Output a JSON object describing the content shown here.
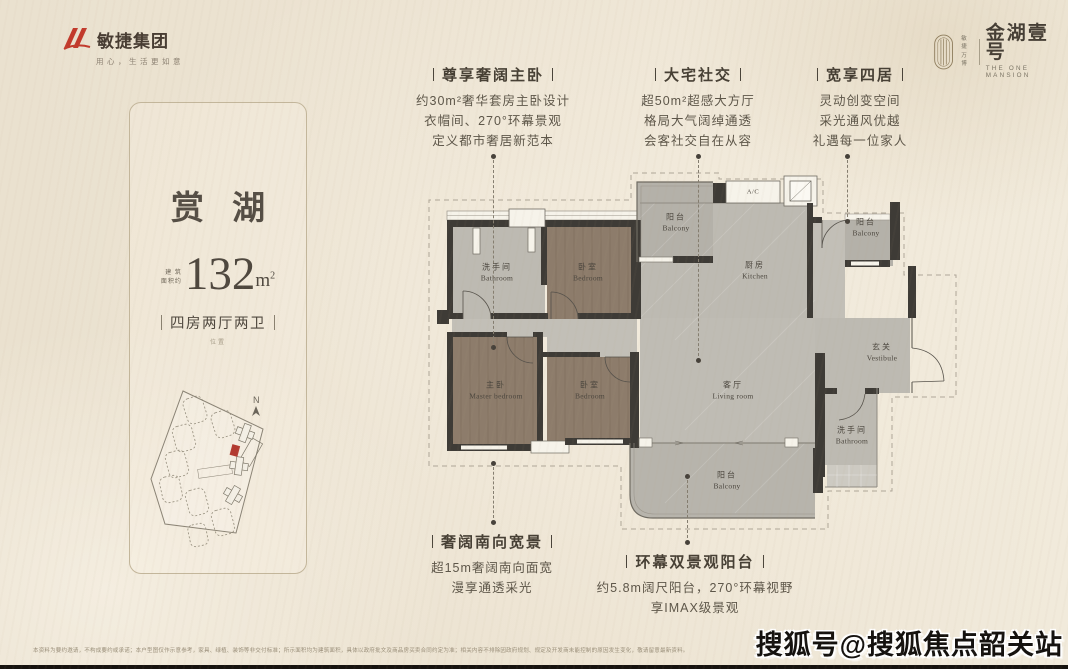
{
  "brand_left": {
    "name": "敏捷集团",
    "slogan": "用心，生活更如意"
  },
  "brand_right": {
    "tag1": "敏捷",
    "tag2": "万博",
    "name": "金湖壹号",
    "name_en": "THE ONE MANSION"
  },
  "card": {
    "title": "赏 湖",
    "area_label_1": "建 筑",
    "area_label_2": "面积约",
    "area_value": "132",
    "area_unit_base": "m",
    "area_unit_sup": "2",
    "layout": "四房两厅两卫",
    "layout_note": "位置",
    "compass_n": "N"
  },
  "plan": {
    "ac": "A/C",
    "rooms": [
      {
        "cn": "洗手间",
        "en": "Bathroom"
      },
      {
        "cn": "卧室",
        "en": "Bedroom"
      },
      {
        "cn": "阳台",
        "en": "Balcony"
      },
      {
        "cn": "厨房",
        "en": "Kitchen"
      },
      {
        "cn": "阳台",
        "en": "Balcony"
      },
      {
        "cn": "玄关",
        "en": "Vestibule"
      },
      {
        "cn": "客厅",
        "en": "Living room"
      },
      {
        "cn": "主卧",
        "en": "Master bedroom"
      },
      {
        "cn": "卧室",
        "en": "Bedroom"
      },
      {
        "cn": "阳台",
        "en": "Balcony"
      },
      {
        "cn": "洗手间",
        "en": "Bathroom"
      }
    ]
  },
  "annotations": [
    {
      "title": "尊享奢阔主卧",
      "lines": [
        "约30m²奢华套房主卧设计",
        "衣帽间、270°环幕景观",
        "定义都市奢居新范本"
      ]
    },
    {
      "title": "大宅社交",
      "lines": [
        "超50m²超感大方厅",
        "格局大气阔绰通透",
        "会客社交自在从容"
      ]
    },
    {
      "title": "宽享四居",
      "lines": [
        "灵动创变空间",
        "采光通风优越",
        "礼遇每一位家人"
      ]
    },
    {
      "title": "奢阔南向宽景",
      "lines": [
        "超15m奢阔南向面宽",
        "漫享通透采光"
      ]
    },
    {
      "title": "环幕双景观阳台",
      "lines": [
        "约5.8m阔尺阳台，270°环幕视野",
        "享IMAX级景观"
      ]
    }
  ],
  "footer": {
    "disclaimer": "本资料为要约邀请，不构成要约或承诺；本户型图仅作示意参考，家具、绿植、装饰等非交付标准；所示面积均为建筑面积，具体以政府批文及商品房买卖合同约定为准；相关内容不排除因政府规划、规定及开发商未能控制的原因发生变化，敬请留意最新资料。",
    "watermark": "搜狐号@搜狐焦点韶关站"
  },
  "colors": {
    "accent_red": "#b23a30",
    "wall": "#3e3b36",
    "wood_floor": "#8d7c6b",
    "gray_floor": "#bdbab2"
  }
}
